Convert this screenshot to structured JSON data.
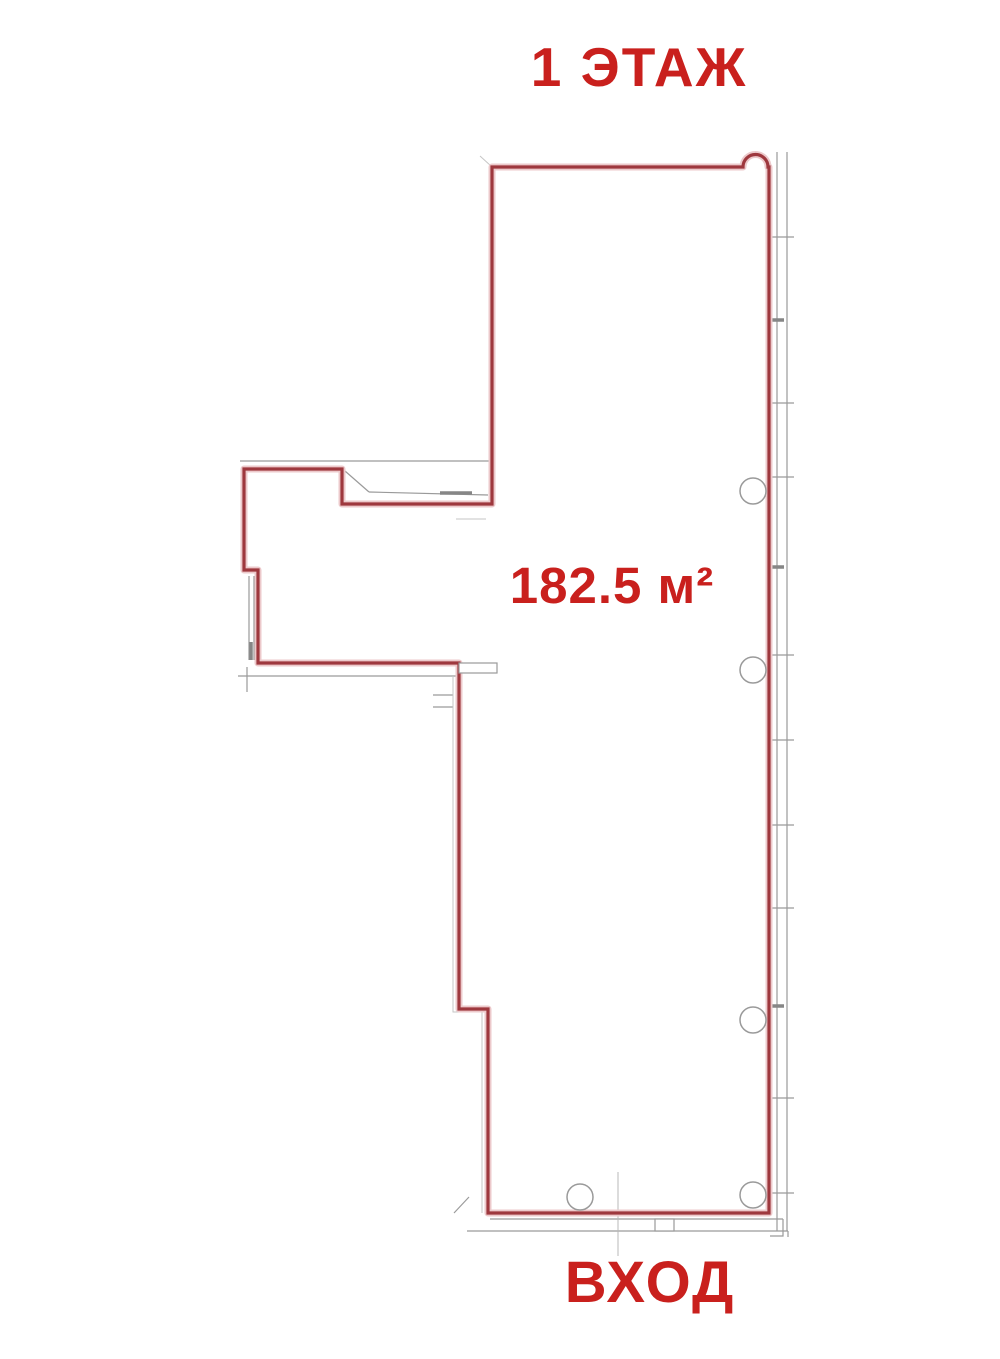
{
  "title": "1 ЭТАЖ",
  "area_label": "182.5 м²",
  "entrance_label": "ВХОД",
  "colors": {
    "label_red": "#c9201d",
    "wall_red": "#9e383e",
    "wall_halo": "#ecc9cb",
    "detail_gray": "#9a9a9a",
    "background": "#ffffff"
  }
}
